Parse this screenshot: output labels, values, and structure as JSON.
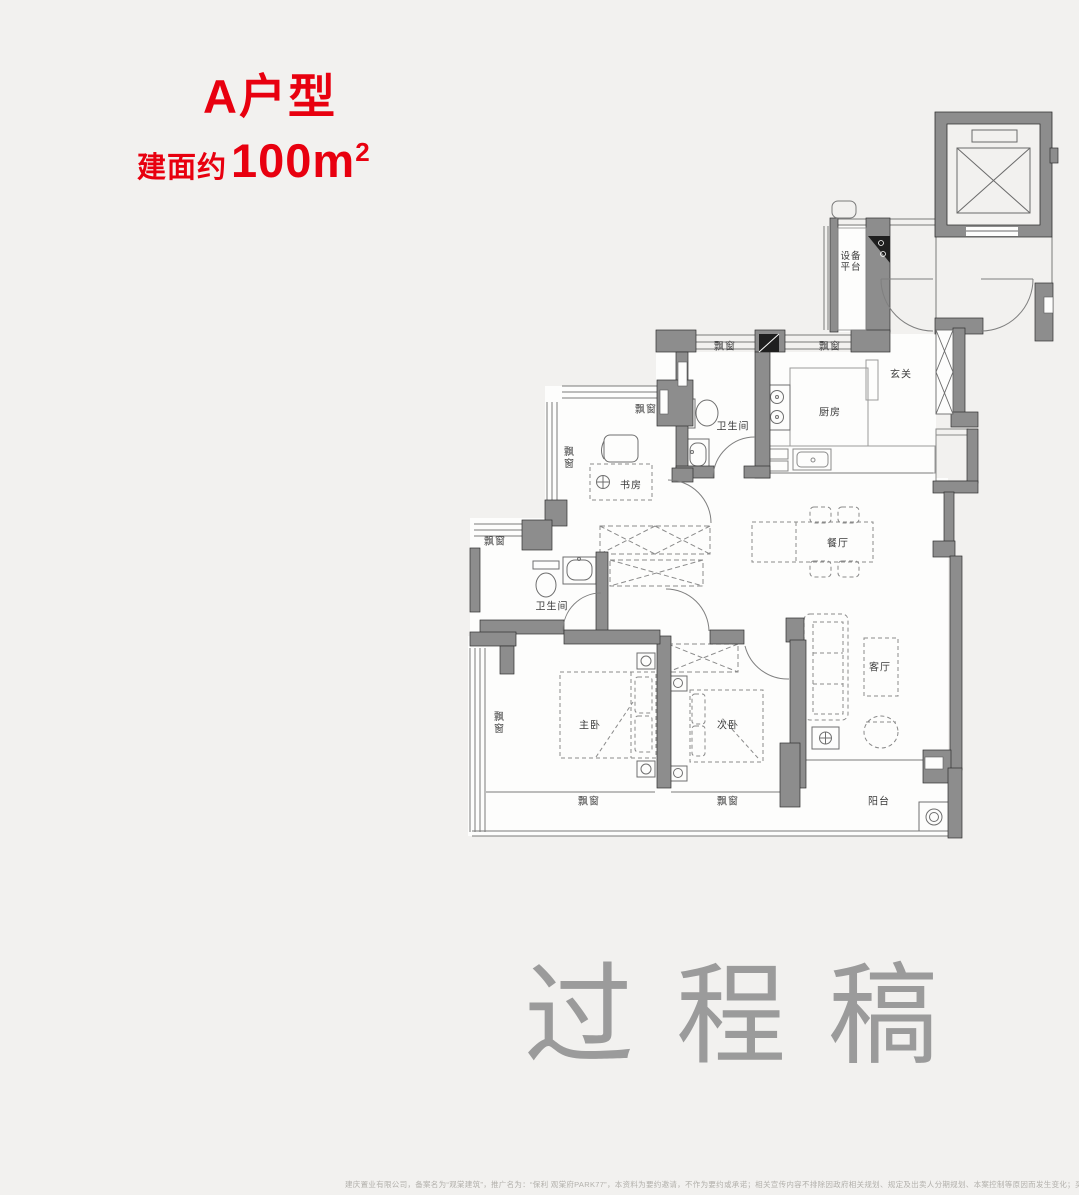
{
  "header": {
    "unit_name": "A户型",
    "area_prefix": "建面约",
    "area_value": "100m",
    "area_sup": "2"
  },
  "watermark": "过程稿",
  "rooms": {
    "equipment_platform": "设备平台",
    "entry": "玄关",
    "kitchen": "厨房",
    "bathroom_top": "卫生间",
    "bathroom_mid": "卫生间",
    "study": "书房",
    "dining": "餐厅",
    "master_bedroom": "主卧",
    "second_bedroom": "次卧",
    "living_room": "客厅",
    "balcony": "阳台",
    "bay_window": "飘窗"
  },
  "footer": {
    "disclaimer": "建庆置业有限公司，备案名为“观棠建筑”，推广名为：“保利 观棠府PARK77”，本资料为要约邀请，不作为要约或承诺；相关宣传内容不排除因政府相关规划、规定及出卖人分期规划、本案控制等原因而发生变化；买卖双方的权利义"
  },
  "colors": {
    "accent_red": "#e8000f",
    "wall_gray": "#8d8d8d",
    "watermark_gray": "#9b9b9b",
    "background": "#f2f1ef",
    "floor_white": "#fdfdfc"
  }
}
